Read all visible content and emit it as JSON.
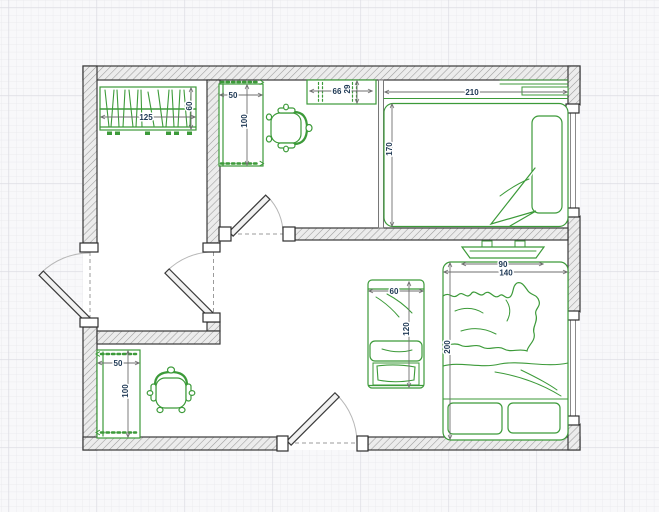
{
  "floorplan": {
    "colors": {
      "canvas_bg": "#f8f8fa",
      "grid_minor": "#ebebef",
      "grid_major": "#dcdce2",
      "wall_fill": "#ececec",
      "wall_hatch": "#9b9b9b",
      "wall_outline": "#3a3a3a",
      "furniture": "#3c9a39",
      "dimension_line": "#6f6f6f",
      "dimension_text": "#203a56",
      "door_arc": "#b7b7b7"
    },
    "dimensions": {
      "wardrobe": {
        "width": "125",
        "depth": "60"
      },
      "desk": {
        "width": "50",
        "depth": "100"
      },
      "shelf": {
        "width": "66",
        "depth": "29"
      },
      "double_bed": {
        "width": "210",
        "depth": "170"
      },
      "bottom_bed": {
        "inner_width": "90",
        "width": "140",
        "length": "200"
      },
      "lounger": {
        "width": "60",
        "length": "120"
      },
      "small_bed": {
        "width": "50",
        "length": "100"
      }
    }
  }
}
